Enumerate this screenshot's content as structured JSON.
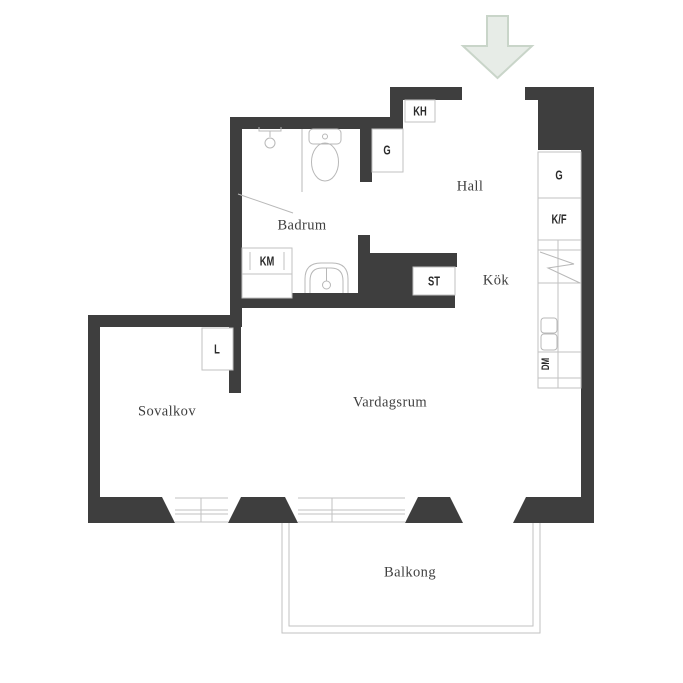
{
  "title": "Apartment floor plan",
  "rooms": {
    "hall": "Hall",
    "kok": "Kök",
    "badrum": "Badrum",
    "sovalkov": "Sovalkov",
    "vardagsrum": "Vardagsrum",
    "balkong": "Balkong"
  },
  "fixtures": {
    "kh": "KH",
    "g_hall": "G",
    "st": "ST",
    "km": "KM",
    "l": "L",
    "g_kitchen": "G",
    "kf": "K/F",
    "dm": "DM"
  },
  "colors": {
    "wall": "#3e3e3e",
    "line": "#c2c2c2",
    "fixture_line": "#b8b8b8",
    "room_text": "#3f3f3f",
    "fixture_text": "#2b2b2b",
    "arrow_fill": "#e7ece7",
    "arrow_stroke": "#c9d5c9",
    "background": "#ffffff"
  }
}
